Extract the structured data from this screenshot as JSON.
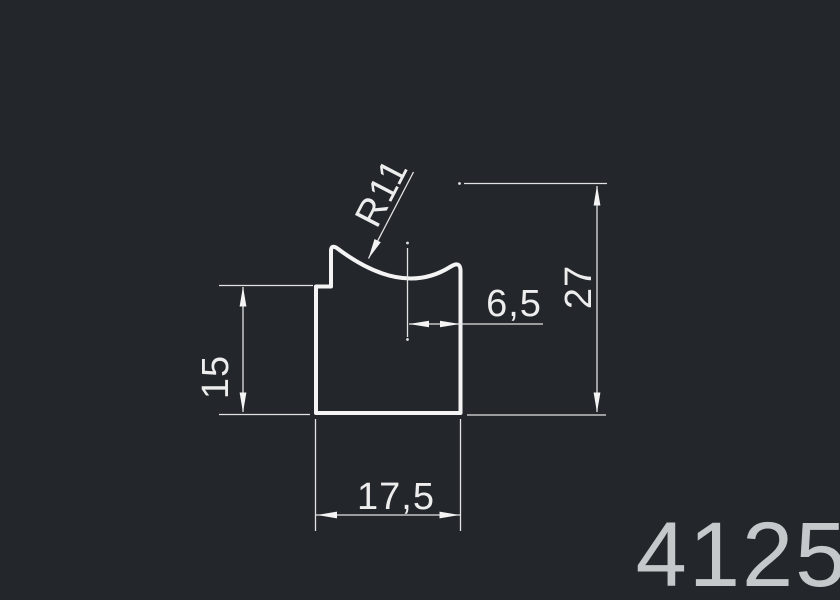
{
  "drawing": {
    "title": "profile-cross-section",
    "profile_number": "4125",
    "dimensions": {
      "radius_label": "R11",
      "center_offset": "6,5",
      "overall_height": "27",
      "left_height": "15",
      "bottom_width": "17,5"
    },
    "colors": {
      "background": "#23272c",
      "profile_line": "#f4f4f4",
      "dimension_line": "#e2e2e2",
      "dimension_text": "#ededed",
      "profile_number_color": "#c5c8ca"
    }
  }
}
